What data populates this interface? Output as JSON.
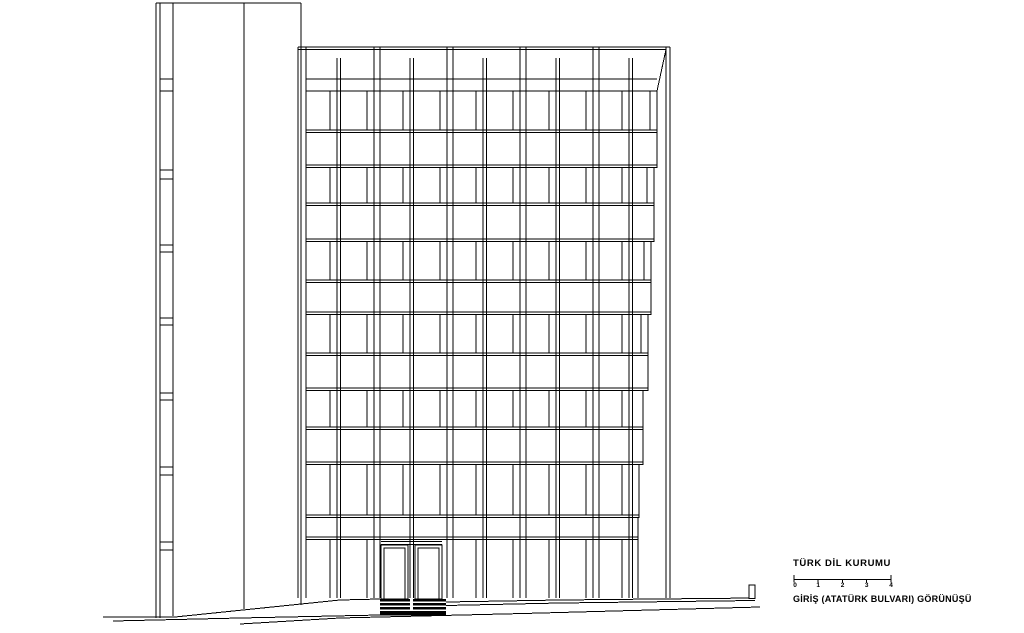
{
  "title_block": {
    "title": "TÜRK DİL KURUMU",
    "caption": "GİRİŞ  (ATATÜRK BULVARI)  GÖRÜNÜŞÜ",
    "scale_labels": [
      "0",
      "1",
      "2",
      "3",
      "4"
    ]
  },
  "colors": {
    "line": "#000000",
    "background": "#ffffff",
    "steps_fill": "#000000"
  },
  "drawing": {
    "canvas": {
      "w": 1024,
      "h": 633
    },
    "tower": {
      "top_line": {
        "x1": 156,
        "x2": 301,
        "y": 3
      },
      "verticals": [
        [
          156,
          3,
          618
        ],
        [
          160,
          3,
          618
        ],
        [
          173,
          3,
          616
        ],
        [
          244,
          3,
          609
        ],
        [
          301,
          3,
          605
        ]
      ],
      "tick_x1": 160,
      "tick_x2": 173,
      "tick_pairs": [
        [
          79,
          91
        ],
        [
          170,
          179
        ],
        [
          245,
          252
        ],
        [
          318,
          325
        ],
        [
          393,
          400
        ],
        [
          467,
          475
        ],
        [
          542,
          550
        ]
      ]
    },
    "facade": {
      "bottom": 598,
      "roof_lines": [
        [
          298,
          670,
          47
        ],
        [
          298,
          666,
          49.5
        ]
      ],
      "major_pairs": [
        [
          298,
          306
        ],
        [
          374,
          380
        ],
        [
          447,
          453
        ],
        [
          520,
          526
        ],
        [
          593,
          599
        ],
        [
          666,
          670
        ]
      ],
      "major_top": 47,
      "mid_pairs": [
        [
          337,
          340.5
        ],
        [
          410,
          413.5
        ],
        [
          483,
          486.5
        ],
        [
          556,
          559.5
        ],
        [
          629,
          632.5
        ]
      ],
      "mid_top": 58,
      "content_left": 306,
      "floor_lines": [
        [
          79,
          657
        ],
        [
          91,
          657
        ],
        [
          130,
          657
        ],
        [
          132.5,
          657
        ],
        [
          165,
          657
        ],
        [
          167.5,
          654
        ],
        [
          203,
          654
        ],
        [
          205.5,
          654
        ],
        [
          239,
          654
        ],
        [
          241.5,
          651
        ],
        [
          280,
          651
        ],
        [
          282.5,
          651
        ],
        [
          312,
          651
        ],
        [
          314.5,
          648
        ],
        [
          353,
          648
        ],
        [
          355.5,
          648
        ],
        [
          388,
          648
        ],
        [
          390.5,
          643
        ],
        [
          427,
          643
        ],
        [
          429.5,
          643
        ],
        [
          462,
          643
        ],
        [
          464.5,
          639
        ],
        [
          515,
          639
        ],
        [
          517.5,
          638
        ],
        [
          537,
          638
        ],
        [
          539.5,
          638
        ]
      ],
      "step_edge": [
        [
          666,
          49.5
        ],
        [
          657,
          91
        ],
        [
          657,
          167.5
        ],
        [
          654,
          167.5
        ],
        [
          654,
          241.5
        ],
        [
          651,
          241.5
        ],
        [
          651,
          314.5
        ],
        [
          648,
          314.5
        ],
        [
          648,
          390.5
        ],
        [
          643,
          390.5
        ],
        [
          643,
          464.5
        ],
        [
          639,
          464.5
        ],
        [
          639,
          517.5
        ],
        [
          638,
          517.5
        ],
        [
          638,
          598
        ]
      ],
      "cells": [
        298,
        337,
        374,
        410,
        447,
        483,
        520,
        556,
        593,
        629,
        666
      ],
      "window_rows": [
        [
          91,
          130
        ],
        [
          167.5,
          203
        ],
        [
          241.5,
          280
        ],
        [
          314.5,
          353
        ],
        [
          390.5,
          427
        ],
        [
          464.5,
          515
        ],
        [
          539.5,
          598
        ]
      ],
      "bay5_edges": [
        657,
        654,
        651,
        648,
        643,
        639,
        638
      ],
      "divider_offset": 7,
      "divider_min_x": 637,
      "ground_row": 6,
      "entrance_cells": [
        2,
        3
      ]
    },
    "entrance": {
      "transoms": [
        [
          381,
          442,
          541.5
        ],
        [
          381,
          442,
          544.5
        ]
      ],
      "doors": [
        [
          381,
          545,
          27,
          54
        ],
        [
          384,
          548,
          21,
          51
        ],
        [
          415,
          545,
          27,
          54
        ],
        [
          418,
          548,
          21,
          51
        ]
      ]
    },
    "steps": {
      "blocks": [
        [
          380,
          410
        ],
        [
          413,
          446
        ]
      ],
      "bars": [
        [
          599,
          2.5
        ],
        [
          603,
          2.5
        ],
        [
          607,
          2.5
        ]
      ],
      "base": [
        380,
        611,
        66,
        4.5
      ]
    },
    "ground": {
      "lines": [
        [
          [
            103,
            617
          ],
          [
            175,
            617
          ],
          [
            340,
            600
          ],
          [
            380,
            599
          ]
        ],
        [
          [
            446,
            602
          ],
          [
            560,
            600
          ],
          [
            755,
            598
          ]
        ],
        [
          [
            446,
            605.5
          ],
          [
            560,
            603
          ],
          [
            755,
            600.5
          ]
        ],
        [
          [
            113,
            621
          ],
          [
            240,
            618
          ],
          [
            380,
            615
          ]
        ],
        [
          [
            240,
            624
          ],
          [
            340,
            618
          ],
          [
            523,
            613.5
          ],
          [
            760,
            607
          ]
        ]
      ],
      "post": [
        749,
        585,
        6,
        13.5
      ]
    }
  }
}
